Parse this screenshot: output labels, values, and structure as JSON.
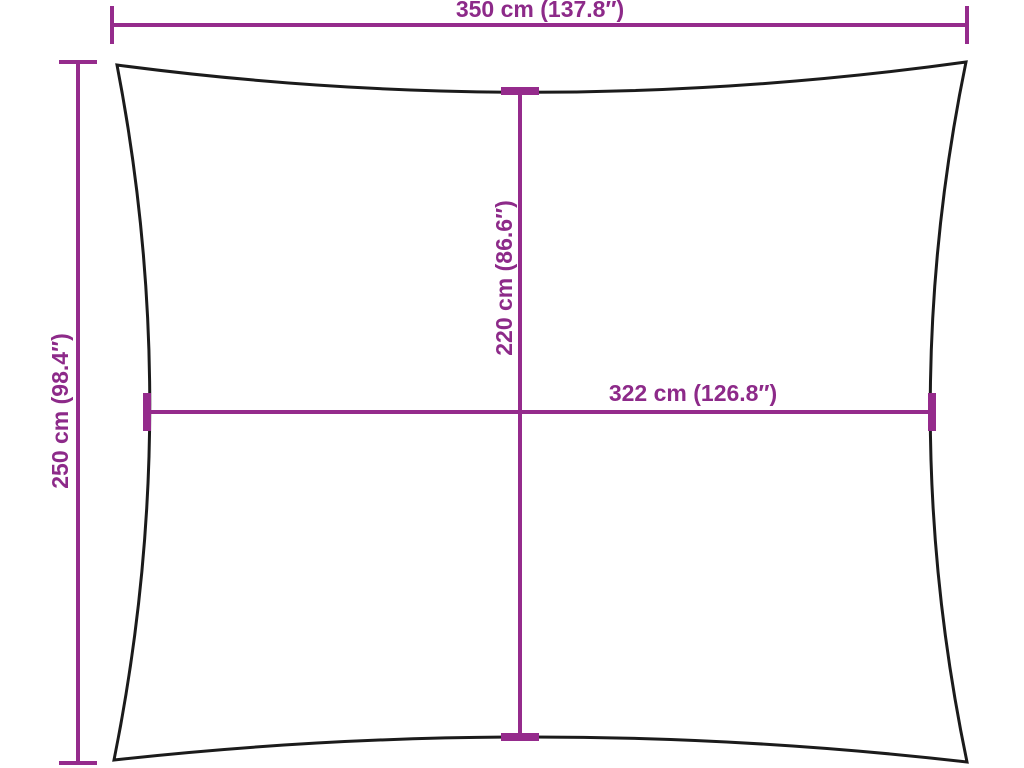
{
  "diagram": {
    "description": "Rectangular shade sail dimension diagram",
    "colors": {
      "dimension_line": "#952b8c",
      "label_text": "#8d2a89",
      "sail_outline": "#1b1b1b",
      "background": "#ffffff"
    },
    "labels": {
      "top_width": "350 cm (137.8″)",
      "left_height": "250 cm (98.4″)",
      "inner_height": "220 cm (86.6″)",
      "inner_width": "322 cm (126.8″)"
    }
  }
}
